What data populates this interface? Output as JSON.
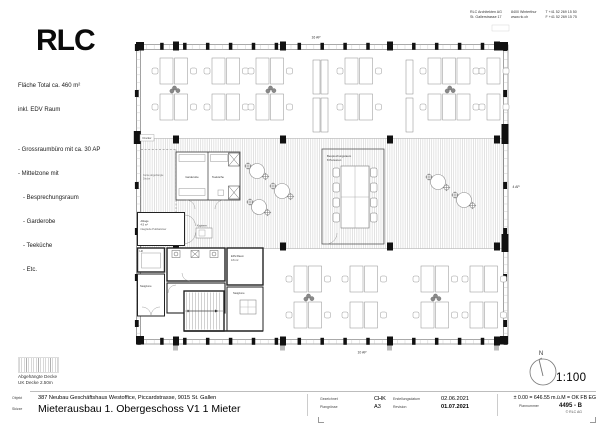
{
  "header": {
    "logo": "RLC",
    "company": [
      [
        "RLC Architekten AG",
        "St. Gallerstrasse 17"
      ],
      [
        "8400 Winterthur",
        "www.rlc.ch"
      ],
      [
        "T +41 52 269 15 50",
        "F +41 52 269 15 75"
      ]
    ]
  },
  "info_block": {
    "lines": [
      "Fläche Total ca. 460 m²",
      "inkl. EDV Raum",
      "",
      "- Grossraumbüro mit ca. 30 AP",
      "- Mittelzone mit",
      "   - Besprechungsraum",
      "   - Garderobe",
      "   - Teeküche",
      "   - Etc."
    ]
  },
  "plan": {
    "labels": {
      "ap_top": "16 AP",
      "ap_right": "4 AP",
      "ap_bottom": "10 AP",
      "garderobe": "Garderobe",
      "teekueche": "Teeküche",
      "besprechung_1": "Besprechungsraum",
      "besprechung_2": "8 Personen",
      "kopierer": "Kopierer",
      "drucker": "Drucker",
      "lift": "Lift",
      "steigzone_links": "Steigzone",
      "steigzone_rechts": "Steigzone",
      "edv_1": "EDV-Raum",
      "edv_2": "4.6 m²",
      "ablage_1": "Ablage",
      "ablage_2": "4.5 m²",
      "ablage_3": "integrierte Putzkammer",
      "kante_1": "Kante abgehängte",
      "kante_2": "Decke"
    }
  },
  "legend": {
    "line1": "Abgehängte Decke",
    "line2": "UK Decke 2.50m",
    "north": "N",
    "scale": "1:100"
  },
  "titleblock": {
    "objekt_label": "Objekt",
    "objekt": "387 Neubau Geschäftshaus Westoffice, Piccardstrasse, 9015 St. Gallen",
    "skizze_label": "Skizze",
    "skizze": "Mieterausbau 1. Obergeschoss V1 1 Mieter",
    "gezeichnet_label": "Gezeichnet",
    "gezeichnet": "CHK",
    "plangroesse_label": "Plangrösse",
    "plangroesse": "A3",
    "erstellung_label": "Erstellungsdatum",
    "erstellung": "02.06.2021",
    "revision_label": "Revision",
    "revision": "01.07.2021",
    "hoehe": "± 0.00 = 646.55 m.ü.M = OK FB EG",
    "plannummer_label": "Plannummer",
    "plannummer": "4495 - B",
    "copyright": "© RLC AG"
  }
}
